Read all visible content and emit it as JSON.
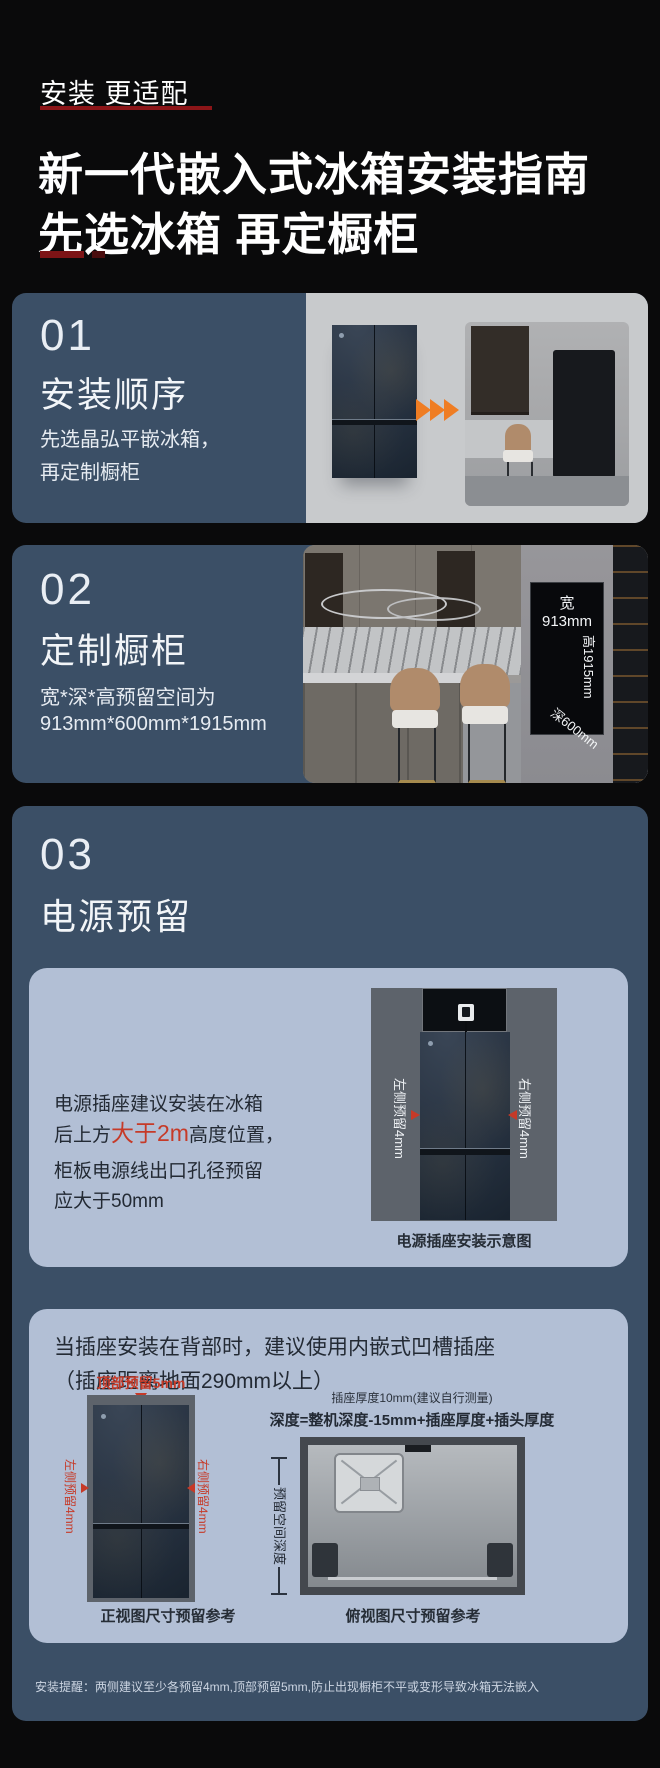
{
  "header": {
    "eyebrow": "安装 更适配",
    "title_line1": "新一代嵌入式冰箱安装指南",
    "title_line2": "先选冰箱 再定橱柜"
  },
  "s1": {
    "num": "01",
    "title": "安装顺序",
    "line1": "先选晶弘平嵌冰箱，",
    "line2": "再定制橱柜"
  },
  "s2": {
    "num": "02",
    "title": "定制橱柜",
    "line1": "宽*深*高预留空间为",
    "line2": "913mm*600mm*1915mm",
    "label_width": "宽913mm",
    "label_height": "高1915mm",
    "label_depth": "深600mm"
  },
  "s3": {
    "num": "03",
    "title": "电源预留",
    "panel_a": {
      "line1": "电源插座建议安装在冰箱",
      "line2_pre": "后上方",
      "line2_red": "大于2m",
      "line2_post": "高度位置，",
      "line3": "柜板电源线出口孔径预留",
      "line4": "应大于50mm",
      "label_left": "左侧预留4mm",
      "label_right": "右侧预留4mm",
      "caption": "电源插座安装示意图"
    },
    "panel_b": {
      "heading1": "当插座安装在背部时，建议使用内嵌式凹槽插座",
      "heading2": "（插座距离地面290mm以上）",
      "top_label": "顶部预留5mm",
      "label_left": "左侧预留4mm",
      "label_right": "右侧预留4mm",
      "front_caption": "正视图尺寸预留参考",
      "socket_note": "插座厚度10mm(建议自行测量)",
      "formula": "深度=整机深度-15mm+插座厚度+插头厚度",
      "depth_label": "预留空间深度",
      "top_caption": "俯视图尺寸预留参考"
    },
    "note": "安装提醒：两侧建议至少各预留4mm,顶部预留5mm,防止出现橱柜不平或变形导致冰箱无法嵌入"
  },
  "colors": {
    "accent_red": "#c63a28",
    "underline_red": "#8c1518",
    "card_blue": "#3b4f66",
    "panel_blue": "#b2bfd5",
    "arrow_orange": "#ef7d23",
    "text_dark": "#232a34"
  }
}
